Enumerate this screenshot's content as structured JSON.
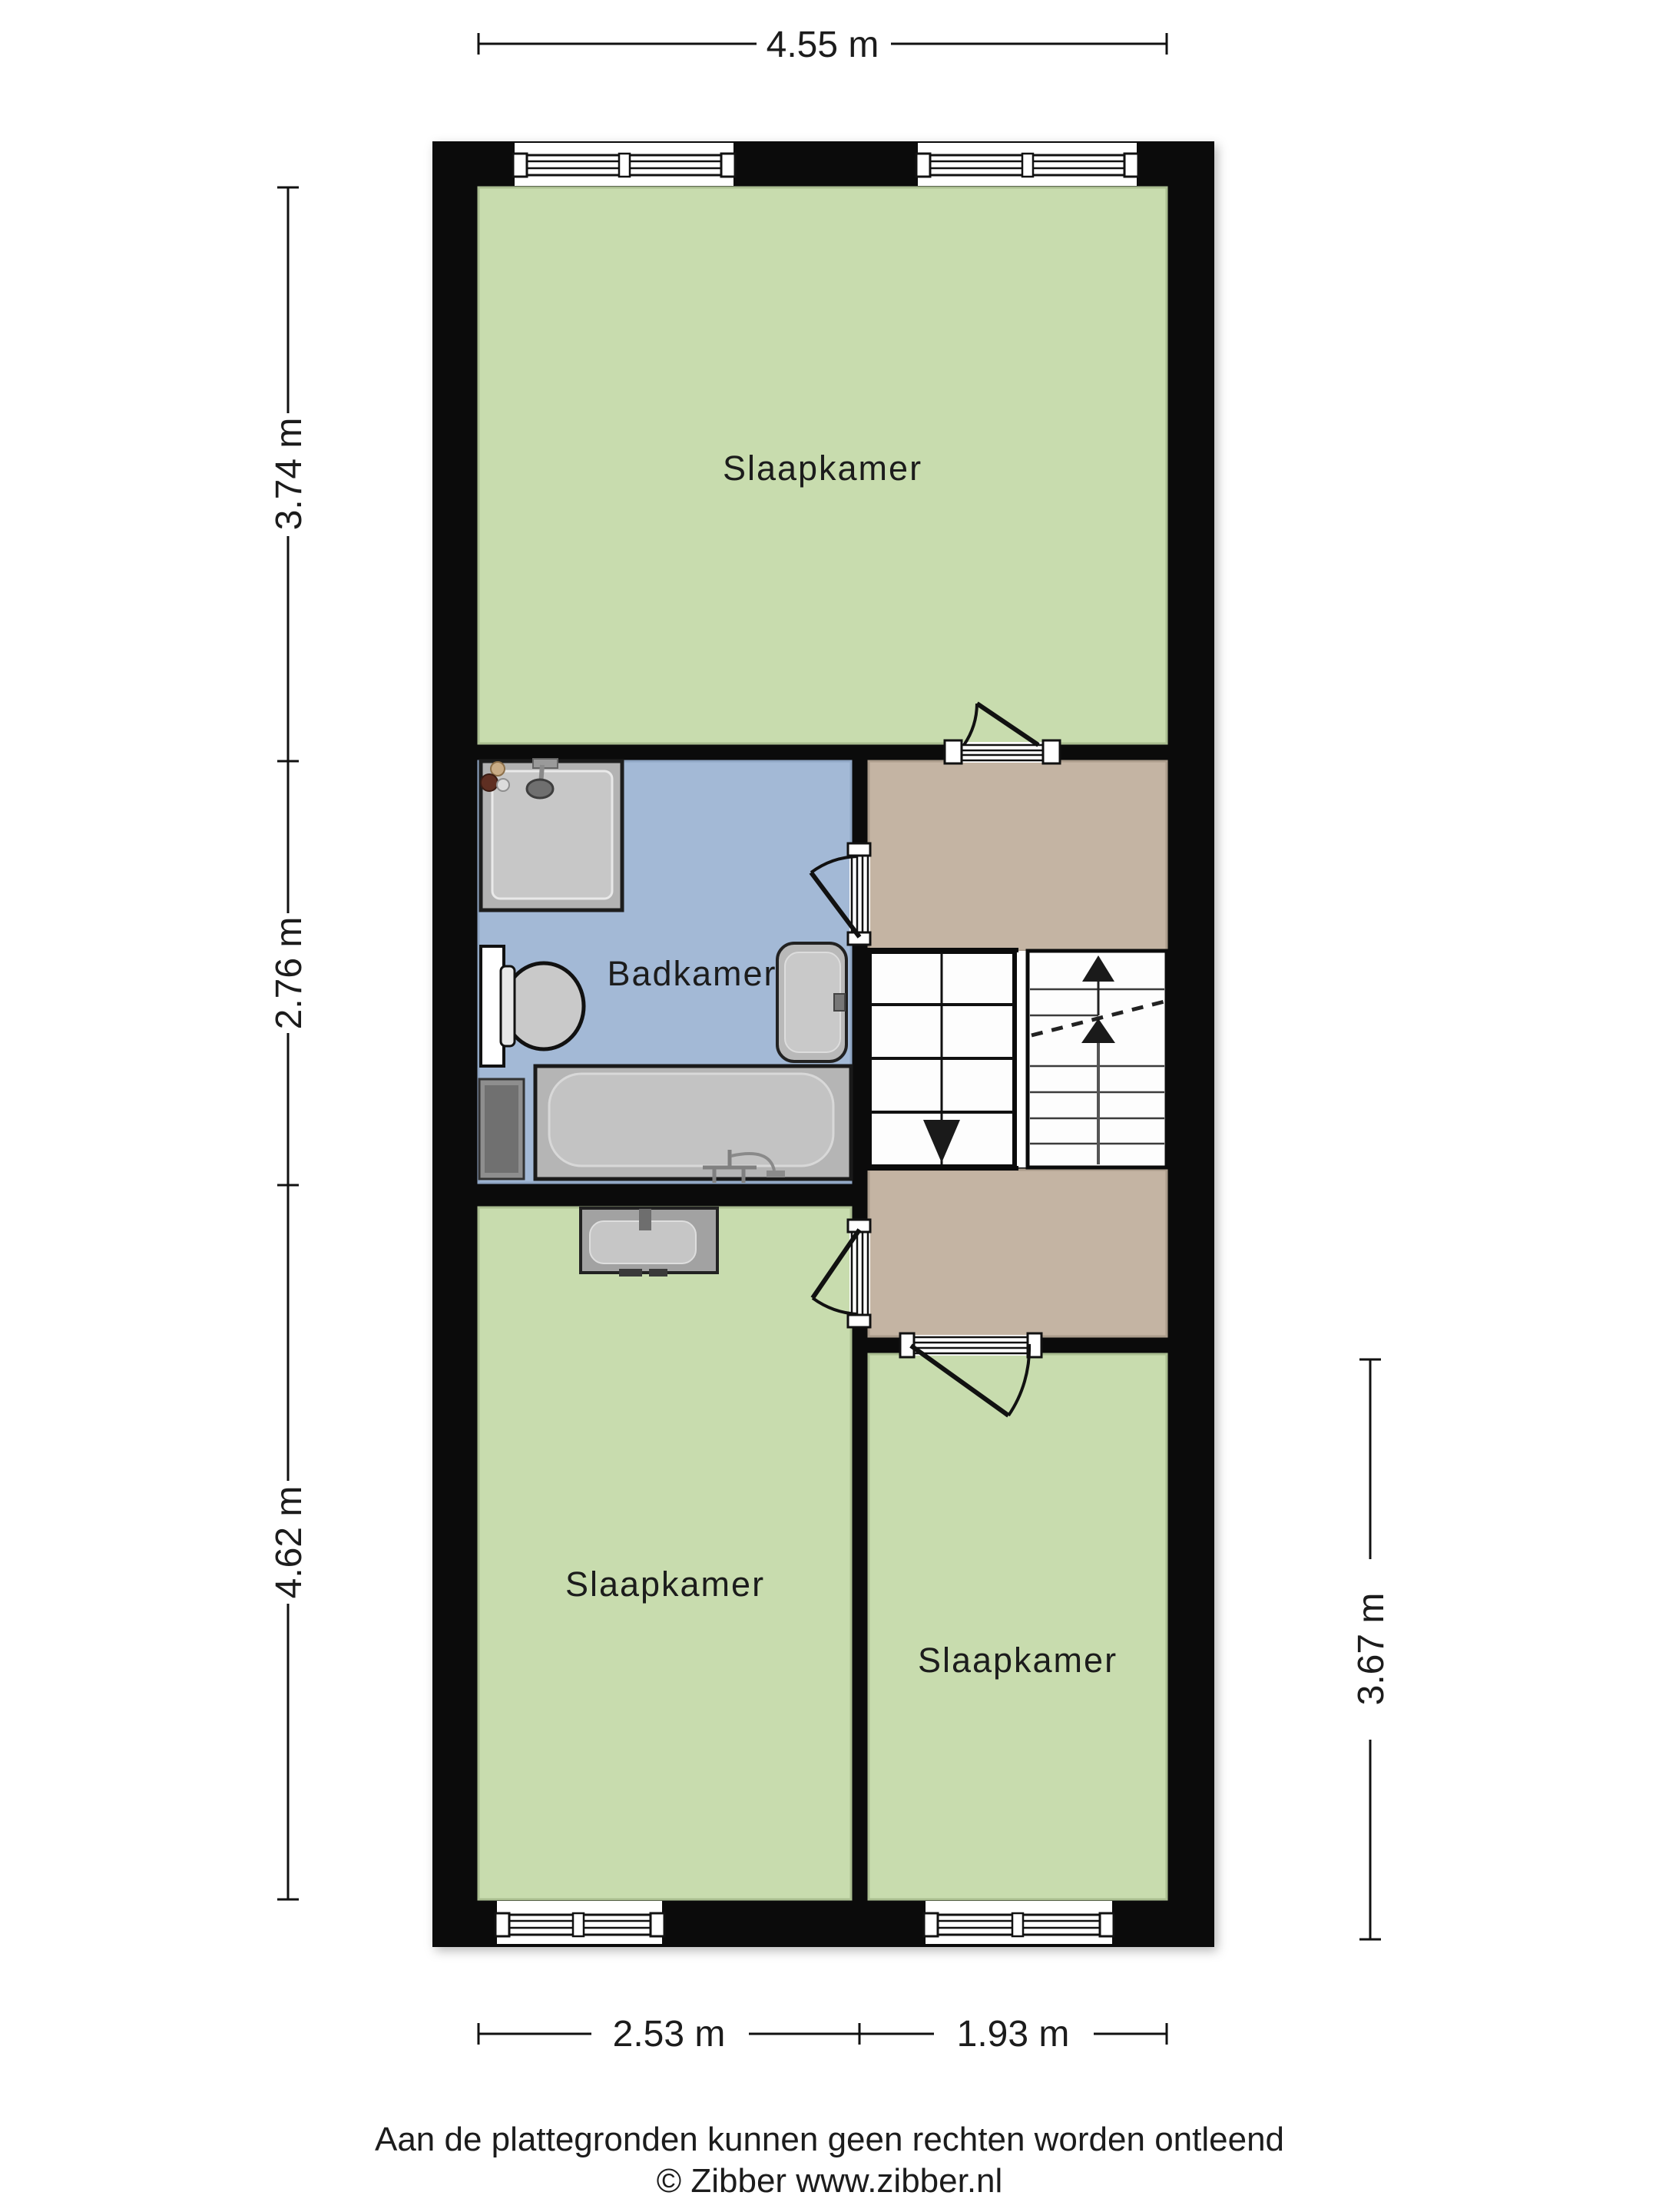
{
  "plan": {
    "rooms": [
      {
        "id": "bedroom-top",
        "label": "Slaapkamer"
      },
      {
        "id": "bathroom",
        "label": "Badkamer"
      },
      {
        "id": "bedroom-bottom-left",
        "label": "Slaapkamer"
      },
      {
        "id": "bedroom-bottom-right",
        "label": "Slaapkamer"
      }
    ],
    "dimensions": {
      "top": "4.55 m",
      "left": [
        "3.74 m",
        "2.76 m",
        "4.62 m"
      ],
      "right": "3.67 m",
      "bottom": [
        "2.53 m",
        "1.93 m"
      ]
    },
    "fixtures": [
      "shower",
      "toilet",
      "washbasin",
      "bathtub",
      "sink",
      "staircase"
    ],
    "stairs": {
      "up_arrows": 2,
      "down_arrows": 1,
      "flights": 2
    },
    "colors": {
      "wall": "#0b0b0b",
      "room_green": "#c8dcae",
      "bathroom_blue": "#a3b9d6",
      "landing_tan": "#c4b4a3",
      "fixture_gray": "#b5b5b5",
      "fixture_light": "#c6c6c6",
      "text": "#1c1c1c"
    }
  },
  "footer": {
    "disclaimer": "Aan de plattegronden kunnen geen rechten worden ontleend",
    "copyright": "© Zibber www.zibber.nl"
  }
}
